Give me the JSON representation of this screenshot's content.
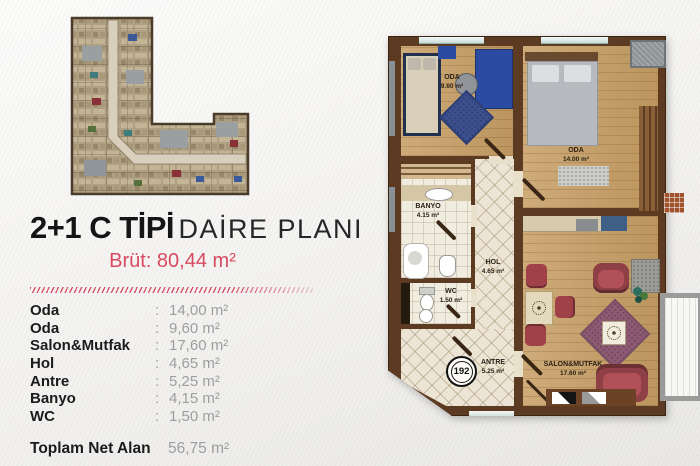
{
  "header": {
    "title_bold": "2+1 C TİPİ",
    "title_light": "DAİRE PLANI",
    "subtitle": "Brüt: 80,44 m²"
  },
  "area_table": {
    "rows": [
      {
        "label": "Oda",
        "sep": ":",
        "value": "14,00 m²"
      },
      {
        "label": "Oda",
        "sep": ":",
        "value": "9,60 m²"
      },
      {
        "label": "Salon&Mutfak",
        "sep": ":",
        "value": "17,60 m²"
      },
      {
        "label": "Hol",
        "sep": ":",
        "value": "4,65 m²"
      },
      {
        "label": "Antre",
        "sep": ":",
        "value": "5,25 m²"
      },
      {
        "label": "Banyo",
        "sep": ":",
        "value": "4,15 m²"
      },
      {
        "label": "WC",
        "sep": ":",
        "value": "1,50 m²"
      }
    ],
    "total_label": "Toplam Net Alan",
    "total_value": "56,75 m²"
  },
  "floor_plan": {
    "unit_number": "192",
    "rooms": {
      "oda_small": {
        "name": "ODA",
        "area": "9.60 m²"
      },
      "oda_big": {
        "name": "ODA",
        "area": "14.00 m²"
      },
      "banyo": {
        "name": "BANYO",
        "area": "4.15 m²"
      },
      "wc": {
        "name": "WC",
        "area": "1.50 m²"
      },
      "hol": {
        "name": "HOL",
        "area": "4.65 m²"
      },
      "antre": {
        "name": "ANTRE",
        "area": "5.25 m²"
      },
      "salon": {
        "name": "SALON&MUTFAK",
        "area": "17.60 m²"
      }
    }
  },
  "colors": {
    "accent_red": "#d84a5f",
    "wall_brown": "#5c3b22",
    "wood_floor": "#c69d63",
    "tile_floor": "#ece4d4",
    "furniture_blue": "#2b4aa2",
    "sofa_red": "#a04048",
    "rug_purple": "#8e5a73",
    "rug_blue": "#3c5090",
    "value_gray": "#9e9e9e"
  }
}
